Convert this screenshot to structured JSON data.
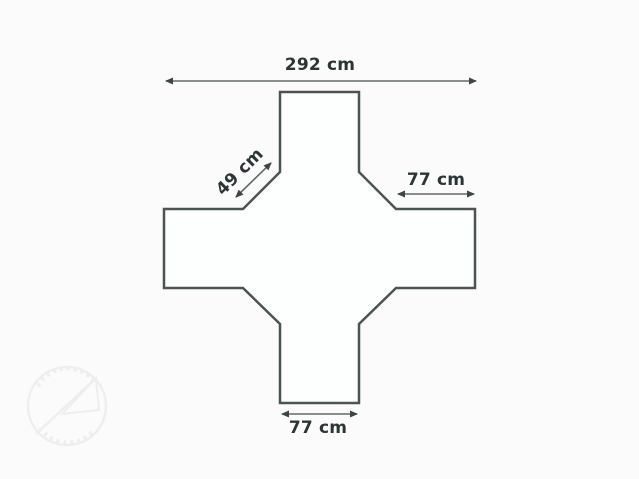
{
  "page": {
    "background_color": "#fbfbfb"
  },
  "diagram": {
    "type": "dimension-drawing",
    "subject": "cross-shaped outline with chamfered inner corners",
    "outline_color": "#4a5553",
    "label_color": "#2c3535",
    "arrow_color": "#636a6a",
    "dimensions": {
      "overall_width": {
        "label": "292 cm",
        "value": 292,
        "unit": "cm"
      },
      "chamfer": {
        "label": "49 cm",
        "value": 49,
        "unit": "cm"
      },
      "right_arm_width": {
        "label": "77 cm",
        "value": 77,
        "unit": "cm"
      },
      "bottom_arm_width": {
        "label": "77 cm",
        "value": 77,
        "unit": "cm"
      }
    }
  },
  "watermark": {
    "name": "circular-logo-watermark",
    "color": "#ededed"
  }
}
